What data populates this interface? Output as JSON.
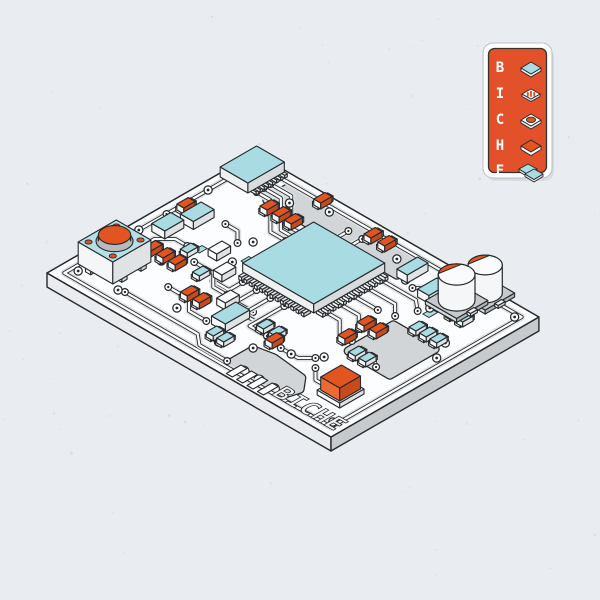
{
  "colors": {
    "bg": "#e9edf2",
    "noise1": "#dde3ea",
    "noise2": "#d3dae2",
    "outline": "#26292c",
    "board_top": "#fbfdfe",
    "slab_left": "#e9ebee",
    "slab_right": "#c6cacd",
    "plane_gray": "#d2d5d8",
    "trace_halo": "#dfe2e5",
    "trace_white": "#ffffff",
    "teal": "#a9dbe2",
    "teal_light": "#b5e0e7",
    "orange": "#e25420",
    "orange_dark": "#c74a1c",
    "orange_light": "#ef6a33",
    "badge_orange": "#e2512a",
    "badge_frame": "#ffffff",
    "silk_text": "#f1f3f4"
  },
  "badge": {
    "rows": [
      {
        "letter": "B",
        "icon": "flat-chip-icon"
      },
      {
        "letter": "I",
        "icon": "striped-resistor-icon"
      },
      {
        "letter": "C",
        "icon": "knob-button-icon"
      },
      {
        "letter": "H",
        "icon": "orange-slab-icon"
      },
      {
        "letter": "E",
        "icon": "stacked-chips-icon"
      }
    ]
  },
  "board": {
    "origin": [
      47,
      273
    ],
    "w": 240,
    "d": 328,
    "thickness": 14,
    "silkscreen": "BICHE",
    "planes": [
      {
        "pts": [
          [
            200,
            54
          ],
          [
            228,
            54
          ],
          [
            228,
            204
          ],
          [
            200,
            204
          ]
        ],
        "scallops": []
      },
      {
        "pts": [
          [
            16,
            196
          ],
          [
            42,
            196
          ],
          [
            46,
            216
          ],
          [
            42,
            252
          ],
          [
            30,
            262
          ],
          [
            16,
            258
          ]
        ],
        "scallops": [
          [
            15,
            212
          ],
          [
            15,
            230
          ],
          [
            15,
            247
          ]
        ]
      },
      {
        "pts": [
          [
            96,
            252
          ],
          [
            148,
            252
          ],
          [
            148,
            300
          ],
          [
            96,
            300
          ]
        ],
        "scallops": []
      }
    ],
    "traces": [
      {
        "pts": [
          [
            10,
            10
          ],
          [
            230,
            10
          ],
          [
            230,
            318
          ],
          [
            10,
            318
          ]
        ],
        "closed": true,
        "pads": false
      },
      {
        "pts": [
          [
            202,
            40
          ],
          [
            202,
            56
          ],
          [
            170,
            88
          ],
          [
            170,
            106
          ]
        ]
      },
      {
        "pts": [
          [
            210,
            40
          ],
          [
            210,
            60
          ],
          [
            178,
            92
          ],
          [
            178,
            110
          ]
        ]
      },
      {
        "pts": [
          [
            218,
            40
          ],
          [
            218,
            64
          ],
          [
            186,
            96
          ],
          [
            186,
            112
          ]
        ]
      },
      {
        "pts": [
          [
            72,
            28
          ],
          [
            96,
            28
          ],
          [
            108,
            40
          ],
          [
            108,
            54
          ]
        ]
      },
      {
        "pts": [
          [
            26,
            64
          ],
          [
            26,
            148
          ],
          [
            16,
            160
          ],
          [
            16,
            192
          ]
        ]
      },
      {
        "pts": [
          [
            104,
            122
          ],
          [
            88,
            122
          ],
          [
            88,
            104
          ]
        ]
      },
      {
        "pts": [
          [
            104,
            138
          ],
          [
            80,
            138
          ],
          [
            80,
            158
          ]
        ]
      },
      {
        "pts": [
          [
            104,
            154
          ],
          [
            72,
            154
          ],
          [
            72,
            176
          ]
        ]
      },
      {
        "pts": [
          [
            104,
            170
          ],
          [
            64,
            170
          ],
          [
            64,
            190
          ]
        ]
      },
      {
        "pts": [
          [
            122,
            200
          ],
          [
            122,
            216
          ],
          [
            108,
            230
          ],
          [
            108,
            244
          ]
        ]
      },
      {
        "pts": [
          [
            138,
            200
          ],
          [
            138,
            222
          ],
          [
            124,
            236
          ]
        ]
      },
      {
        "pts": [
          [
            154,
            200
          ],
          [
            154,
            228
          ]
        ]
      },
      {
        "pts": [
          [
            170,
            200
          ],
          [
            170,
            232
          ],
          [
            158,
            244
          ]
        ]
      },
      {
        "pts": [
          [
            186,
            200
          ],
          [
            186,
            240
          ],
          [
            176,
            252
          ]
        ]
      },
      {
        "pts": [
          [
            96,
            74
          ],
          [
            96,
            96
          ],
          [
            82,
            110
          ],
          [
            82,
            126
          ]
        ]
      },
      {
        "pts": [
          [
            56,
            84
          ],
          [
            56,
            108
          ],
          [
            44,
            120
          ],
          [
            44,
            140
          ]
        ]
      },
      {
        "pts": [
          [
            198,
            132
          ],
          [
            216,
            132
          ]
        ]
      },
      {
        "pts": [
          [
            198,
            148
          ],
          [
            216,
            148
          ]
        ]
      },
      {
        "pts": [
          [
            205,
            252
          ],
          [
            205,
            236
          ],
          [
            196,
            226
          ]
        ]
      },
      {
        "pts": [
          [
            229,
            261
          ],
          [
            229,
            242
          ]
        ]
      },
      {
        "pts": [
          [
            48,
            278
          ],
          [
            48,
            262
          ],
          [
            60,
            250
          ]
        ]
      },
      {
        "pts": [
          [
            104,
            258
          ],
          [
            104,
            274
          ],
          [
            96,
            284
          ]
        ]
      },
      {
        "pts": [
          [
            152,
            54
          ],
          [
            152,
            68
          ],
          [
            140,
            80
          ]
        ]
      },
      {
        "pts": [
          [
            128,
            10
          ],
          [
            128,
            24
          ]
        ]
      },
      {
        "pts": [
          [
            60,
            210
          ],
          [
            60,
            230
          ],
          [
            70,
            240
          ]
        ]
      }
    ],
    "vias": [
      [
        20,
        16
      ],
      [
        226,
        16
      ],
      [
        226,
        314
      ],
      [
        16,
        314
      ],
      [
        40,
        110
      ],
      [
        30,
        168
      ],
      [
        118,
        96
      ],
      [
        150,
        88
      ],
      [
        200,
        214
      ],
      [
        186,
        256
      ],
      [
        160,
        300
      ],
      [
        60,
        222
      ],
      [
        76,
        244
      ],
      [
        44,
        194
      ],
      [
        210,
        70
      ],
      [
        224,
        102
      ],
      [
        216,
        188
      ],
      [
        130,
        108
      ],
      [
        24,
        58
      ],
      [
        78,
        54
      ],
      [
        96,
        10
      ],
      [
        176,
        10
      ],
      [
        224,
        284
      ],
      [
        140,
        310
      ]
    ],
    "flat_pads": [
      [
        108,
        62,
        9,
        6
      ],
      [
        58,
        148,
        9,
        6
      ],
      [
        176,
        258,
        10,
        7
      ],
      [
        124,
        100,
        9,
        6
      ]
    ],
    "fingers": [
      [
        3,
        204,
        17,
        7
      ],
      [
        3,
        216,
        17,
        7
      ],
      [
        3,
        228,
        17,
        7
      ],
      [
        3,
        240,
        17,
        7
      ]
    ],
    "components": {
      "button": {
        "u": 27,
        "v": 9,
        "w": 44,
        "d": 40,
        "h": 22
      },
      "soic": {
        "u": 196,
        "v": 4,
        "w": 42,
        "d": 32,
        "h": 10,
        "pins": 8
      },
      "qfp": {
        "u": 112,
        "v": 114,
        "w": 82,
        "d": 82,
        "h": 9,
        "pins": 13
      },
      "ecaps": [
        {
          "cu": 205,
          "cv": 268,
          "r": 15,
          "h": 26
        },
        {
          "cu": 229,
          "cv": 277,
          "r": 14,
          "h": 28
        }
      ],
      "cube": {
        "u": 36,
        "v": 280,
        "w": 24,
        "d": 22,
        "h": 13
      },
      "smd_orange": [
        [
          138,
          12
        ],
        [
          184,
          62
        ],
        [
          184,
          76
        ],
        [
          184,
          90
        ],
        [
          76,
          36
        ],
        [
          76,
          50
        ],
        [
          76,
          64
        ],
        [
          52,
          102
        ],
        [
          52,
          116
        ],
        [
          124,
          234
        ],
        [
          124,
          248
        ],
        [
          216,
          150
        ],
        [
          216,
          166
        ],
        [
          222,
          86
        ],
        [
          54,
          198
        ],
        [
          100,
          236
        ]
      ],
      "smd_teal": [
        [
          96,
          58
        ],
        [
          80,
          88
        ],
        [
          28,
          156
        ],
        [
          28,
          168
        ],
        [
          64,
          178
        ],
        [
          64,
          192
        ],
        [
          90,
          258
        ],
        [
          90,
          270
        ],
        [
          150,
          268
        ],
        [
          150,
          280
        ],
        [
          150,
          292
        ],
        [
          186,
          274
        ],
        [
          186,
          286
        ]
      ],
      "box_teal": [
        [
          128,
          26,
          24,
          15
        ],
        [
          102,
          19,
          22,
          15
        ],
        [
          44,
          146,
          28,
          16
        ],
        [
          190,
          238,
          22,
          13
        ],
        [
          198,
          206,
          24,
          12
        ]
      ],
      "box_white": [
        [
          92,
          100,
          16,
          10
        ],
        [
          66,
          130,
          16,
          10
        ],
        [
          110,
          76,
          16,
          10
        ]
      ]
    }
  }
}
